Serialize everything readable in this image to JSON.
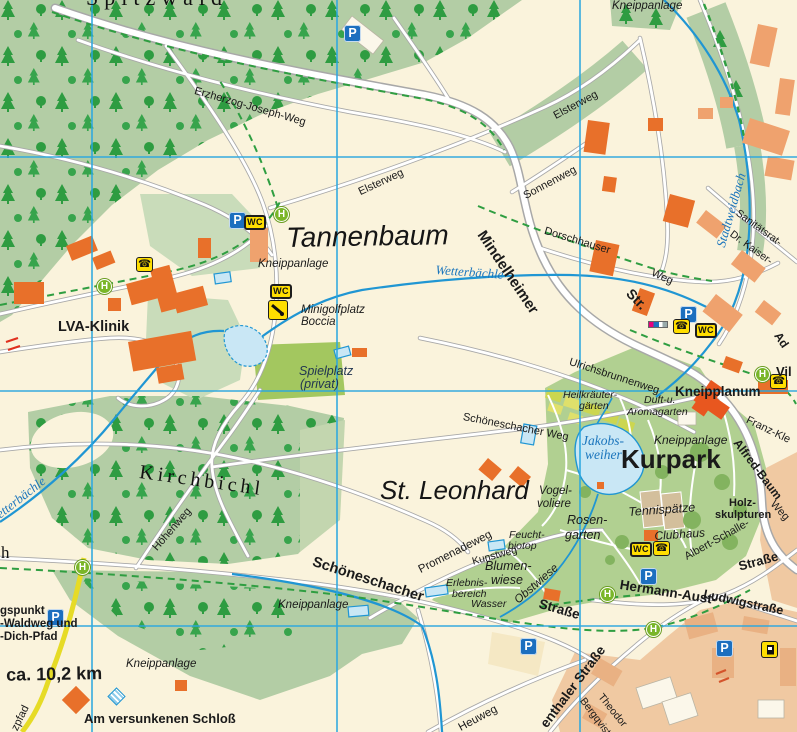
{
  "colors": {
    "background_cream": "#FAF3DC",
    "forest_green": "#B3CDA5",
    "tree_green": "#2E9C41",
    "park_green": "#B1D091",
    "pale_green": "#C9DCBA",
    "playground_lime": "#A3C75F",
    "garden_yellow_green": "#CCD64F",
    "urban_tan": "#F0C9A2",
    "building_orange": "#E8702A",
    "building_salmon": "#EFA26E",
    "road_white": "#FFFFFF",
    "road_casing": "#A8A8A8",
    "grid_blue": "#2AA7E0",
    "stream_blue": "#2096D3",
    "pond_fill": "#C9E7F5",
    "trail_green_dash": "#2F9E41",
    "trail_yellow": "#E6DB26",
    "icon_blue": "#1C6FBF",
    "icon_yellow": "#FFDE00",
    "bus_stop_green": "#7AB629",
    "water_label_blue": "#1B75BC"
  },
  "grid": {
    "vertical_x": [
      92,
      337,
      580
    ],
    "horizontal_y": [
      157,
      391,
      626
    ]
  },
  "icon_glyphs": {
    "parking": "P",
    "wc": "WC",
    "bus_stop": "H",
    "phone": "☎"
  },
  "icons": [
    {
      "type": "parking",
      "x": 344,
      "y": 25
    },
    {
      "type": "parking",
      "x": 229,
      "y": 212
    },
    {
      "type": "parking",
      "x": 680,
      "y": 306
    },
    {
      "type": "parking",
      "x": 640,
      "y": 568
    },
    {
      "type": "parking",
      "x": 520,
      "y": 638
    },
    {
      "type": "parking",
      "x": 47,
      "y": 609
    },
    {
      "type": "parking",
      "x": 716,
      "y": 640
    },
    {
      "type": "wc",
      "x": 244,
      "y": 215
    },
    {
      "type": "wc",
      "x": 270,
      "y": 284
    },
    {
      "type": "wc",
      "x": 695,
      "y": 323
    },
    {
      "type": "wc",
      "x": 630,
      "y": 542
    },
    {
      "type": "bus_stop",
      "x": 274,
      "y": 207
    },
    {
      "type": "bus_stop",
      "x": 97,
      "y": 279
    },
    {
      "type": "bus_stop",
      "x": 75,
      "y": 560
    },
    {
      "type": "bus_stop",
      "x": 755,
      "y": 367
    },
    {
      "type": "bus_stop",
      "x": 600,
      "y": 587
    },
    {
      "type": "bus_stop",
      "x": 646,
      "y": 622
    },
    {
      "type": "phone",
      "x": 136,
      "y": 257
    },
    {
      "type": "phone",
      "x": 673,
      "y": 319
    },
    {
      "type": "phone",
      "x": 653,
      "y": 541
    },
    {
      "type": "phone",
      "x": 770,
      "y": 374
    },
    {
      "type": "fuel",
      "x": 761,
      "y": 641
    },
    {
      "type": "minigolf",
      "x": 268,
      "y": 300
    },
    {
      "type": "kneipp",
      "x": 110,
      "y": 690
    },
    {
      "type": "poi_strip",
      "x": 648,
      "y": 321
    }
  ],
  "labels": [
    {
      "id": "spitzwald",
      "text": "Spitzwald",
      "x": 86,
      "y": -13,
      "r": 0,
      "cls": "serif",
      "fs": 22,
      "ls": 6
    },
    {
      "id": "erzherzog-joseph-weg",
      "text": "Erzherzog-Joseph-Weg",
      "x": 196,
      "y": 86,
      "r": 16,
      "cls": "n",
      "fs": 11
    },
    {
      "id": "kneippanlage-top",
      "text": "Kneippanlage",
      "x": 612,
      "y": 1,
      "r": 0,
      "cls": "it",
      "fs": 11.5
    },
    {
      "id": "elsterweg-east",
      "text": "Elsterweg",
      "x": 552,
      "y": 112,
      "r": -28,
      "cls": "n",
      "fs": 11
    },
    {
      "id": "elsterweg-west",
      "text": "Elsterweg",
      "x": 357,
      "y": 188,
      "r": -25,
      "cls": "n",
      "fs": 11
    },
    {
      "id": "sonnenweg",
      "text": "Sonnenweg",
      "x": 522,
      "y": 192,
      "r": -28,
      "cls": "n",
      "fs": 11
    },
    {
      "id": "mindelheimer",
      "text": "Mindelheimer",
      "x": 487,
      "y": 228,
      "r": 56,
      "cls": "b",
      "fs": 15
    },
    {
      "id": "str",
      "text": "Str.",
      "x": 634,
      "y": 286,
      "r": 46,
      "cls": "b",
      "fs": 14
    },
    {
      "id": "dorschhauser",
      "text": "Dorschhauser",
      "x": 546,
      "y": 226,
      "r": 17,
      "cls": "n",
      "fs": 11
    },
    {
      "id": "dorschhauser-weg",
      "text": "Weg",
      "x": 654,
      "y": 268,
      "r": 24,
      "cls": "n",
      "fs": 11
    },
    {
      "id": "stadtweidbach",
      "text": "Stadtweidbach",
      "x": 714,
      "y": 245,
      "r": -74,
      "cls": "w",
      "fs": 13
    },
    {
      "id": "sanitaetsrat",
      "text": "Sanitätsrat-",
      "x": 740,
      "y": 208,
      "r": 36,
      "cls": "n",
      "fs": 10.5
    },
    {
      "id": "dr-kaiser",
      "text": "Dr. Kaiser-",
      "x": 734,
      "y": 229,
      "r": 36,
      "cls": "n",
      "fs": 10.5
    },
    {
      "id": "tannenbaum",
      "text": "Tannenbaum",
      "x": 286,
      "y": 224,
      "r": -1,
      "cls": "pl",
      "fs": 28
    },
    {
      "id": "kneippanlage-tannenbaum",
      "text": "Kneippanlage",
      "x": 258,
      "y": 259,
      "r": 0,
      "cls": "it",
      "fs": 11.5
    },
    {
      "id": "wetterbaechle-mid",
      "text": "Wetterbächle",
      "x": 436,
      "y": 263,
      "r": 4,
      "cls": "w",
      "fs": 13
    },
    {
      "id": "minigolfplatz",
      "text": "Minigolfplatz",
      "x": 301,
      "y": 305,
      "r": 0,
      "cls": "it",
      "fs": 11.5
    },
    {
      "id": "boccia",
      "text": "Boccia",
      "x": 301,
      "y": 317,
      "r": 0,
      "cls": "it",
      "fs": 11.5
    },
    {
      "id": "lva-klinik",
      "text": "LVA-Klinik",
      "x": 58,
      "y": 320,
      "r": 0,
      "cls": "b",
      "fs": 14.5
    },
    {
      "id": "spielplatz",
      "text": "Spielplatz",
      "x": 299,
      "y": 365,
      "r": 0,
      "cls": "nav",
      "fs": 12.5
    },
    {
      "id": "spielplatz-privat",
      "text": "(privat)",
      "x": 300,
      "y": 378,
      "r": 0,
      "cls": "nav",
      "fs": 12.5
    },
    {
      "id": "ulrichsbrunnenweg",
      "text": "Ulrichsbrunnenweg",
      "x": 571,
      "y": 357,
      "r": 18,
      "cls": "n",
      "fs": 11
    },
    {
      "id": "heilkraeuter-1",
      "text": "Heilkräuter-",
      "x": 563,
      "y": 390,
      "r": 0,
      "cls": "it",
      "fs": 10.5
    },
    {
      "id": "heilkraeuter-2",
      "text": "gärten",
      "x": 579,
      "y": 401,
      "r": 0,
      "cls": "it",
      "fs": 10.5
    },
    {
      "id": "duft-u",
      "text": "Duft-u.",
      "x": 644,
      "y": 395,
      "r": 0,
      "cls": "it",
      "fs": 10.5
    },
    {
      "id": "aromagarten",
      "text": "Aromagarten",
      "x": 627,
      "y": 407,
      "r": 0,
      "cls": "it",
      "fs": 10.5
    },
    {
      "id": "kneipplanum",
      "text": "Kneipplanum",
      "x": 675,
      "y": 385,
      "r": 0,
      "cls": "b",
      "fs": 13.5
    },
    {
      "id": "franz-kle",
      "text": "Franz-Kle",
      "x": 749,
      "y": 415,
      "r": 26,
      "cls": "n",
      "fs": 11
    },
    {
      "id": "jakobsweiher-1",
      "text": "Jakobs-",
      "x": 582,
      "y": 434,
      "r": 0,
      "cls": "w",
      "fs": 13.5
    },
    {
      "id": "jakobsweiher-2",
      "text": "weiher",
      "x": 585,
      "y": 448,
      "r": 0,
      "cls": "w",
      "fs": 13.5
    },
    {
      "id": "kneippanlage-kurpark",
      "text": "Kneippanlage",
      "x": 654,
      "y": 434,
      "r": 0,
      "cls": "it",
      "fs": 12
    },
    {
      "id": "kurpark",
      "text": "Kurpark",
      "x": 621,
      "y": 446,
      "r": 0,
      "cls": "b",
      "fs": 26
    },
    {
      "id": "alfred-baum",
      "text": "Alfred-Baum",
      "x": 741,
      "y": 437,
      "r": 53,
      "cls": "b",
      "fs": 12
    },
    {
      "id": "weg-right",
      "text": "Weg",
      "x": 776,
      "y": 499,
      "r": 48,
      "cls": "n",
      "fs": 11
    },
    {
      "id": "vogelvoliere-1",
      "text": "Vogel-",
      "x": 539,
      "y": 486,
      "r": 0,
      "cls": "it",
      "fs": 11.5
    },
    {
      "id": "vogelvoliere-2",
      "text": "voliere",
      "x": 537,
      "y": 499,
      "r": 0,
      "cls": "it",
      "fs": 11.5
    },
    {
      "id": "rosengarten-1",
      "text": "Rosen-",
      "x": 567,
      "y": 514,
      "r": 0,
      "cls": "it",
      "fs": 12.5
    },
    {
      "id": "rosengarten-2",
      "text": "garten",
      "x": 565,
      "y": 529,
      "r": 0,
      "cls": "it",
      "fs": 12.5
    },
    {
      "id": "st-leonhard",
      "text": "St. Leonhard",
      "x": 380,
      "y": 477,
      "r": 0,
      "cls": "pl",
      "fs": 26
    },
    {
      "id": "promenadeweg",
      "text": "Promenadeweg",
      "x": 417,
      "y": 566,
      "r": -27,
      "cls": "n",
      "fs": 11.5
    },
    {
      "id": "kunstweg",
      "text": "Kunstweg",
      "x": 471,
      "y": 557,
      "r": -15,
      "cls": "n",
      "fs": 10.5
    },
    {
      "id": "feuchtbiotop-1",
      "text": "Feucht-",
      "x": 509,
      "y": 530,
      "r": 0,
      "cls": "it",
      "fs": 10.5
    },
    {
      "id": "feuchtbiotop-2",
      "text": "biotop",
      "x": 508,
      "y": 541,
      "r": 0,
      "cls": "it",
      "fs": 10.5
    },
    {
      "id": "blumenwiese-1",
      "text": "Blumen-",
      "x": 485,
      "y": 560,
      "r": 0,
      "cls": "it",
      "fs": 12.5
    },
    {
      "id": "blumenwiese-2",
      "text": "wiese",
      "x": 491,
      "y": 574,
      "r": 0,
      "cls": "it",
      "fs": 12.5
    },
    {
      "id": "obstwiese",
      "text": "Obstwiese",
      "x": 513,
      "y": 598,
      "r": -41,
      "cls": "it",
      "fs": 11.5
    },
    {
      "id": "erlebnisbereich-1",
      "text": "Erlebnis-",
      "x": 446,
      "y": 578,
      "r": 0,
      "cls": "it",
      "fs": 10.5
    },
    {
      "id": "erlebnisbereich-2",
      "text": "bereich",
      "x": 452,
      "y": 589,
      "r": 0,
      "cls": "it",
      "fs": 10.5
    },
    {
      "id": "erlebnisbereich-3",
      "text": "Wasser",
      "x": 471,
      "y": 599,
      "r": 0,
      "cls": "it",
      "fs": 10.5
    },
    {
      "id": "schoeneschacher",
      "text": "Schöneschacher",
      "x": 315,
      "y": 555,
      "r": 18,
      "cls": "b",
      "fs": 14.5
    },
    {
      "id": "strasse-schoeneschacher",
      "text": "Straße",
      "x": 541,
      "y": 597,
      "r": 16,
      "cls": "b",
      "fs": 13.5
    },
    {
      "id": "schoeneschacher-weg",
      "text": "Schöneschacher Weg",
      "x": 464,
      "y": 412,
      "r": 11,
      "cls": "n",
      "fs": 11
    },
    {
      "id": "hermann-aust",
      "text": "Hermann-Aust-",
      "x": 621,
      "y": 578,
      "r": 9,
      "cls": "b",
      "fs": 13.5
    },
    {
      "id": "strasse-hermann-aust",
      "text": "Straße",
      "x": 737,
      "y": 560,
      "r": -15,
      "cls": "b",
      "fs": 13
    },
    {
      "id": "ludwigstrasse",
      "text": "Ludwigstraße",
      "x": 705,
      "y": 588,
      "r": 12,
      "cls": "b",
      "fs": 12.5
    },
    {
      "id": "kirchbichl",
      "text": "Kirchbichl",
      "x": 141,
      "y": 462,
      "r": 8,
      "cls": "serif",
      "fs": 20,
      "ls": 4
    },
    {
      "id": "hoehenweg",
      "text": "Höhenweg",
      "x": 151,
      "y": 546,
      "r": -49,
      "cls": "n",
      "fs": 11
    },
    {
      "id": "wetterbaechle-west",
      "text": "Wetterbächle",
      "x": -14,
      "y": 516,
      "r": -38,
      "cls": "w",
      "fs": 13
    },
    {
      "id": "cut-h",
      "text": "h",
      "x": 1,
      "y": 544,
      "r": 0,
      "cls": "serif",
      "fs": 17
    },
    {
      "id": "tennisplaetze",
      "text": "Tennispätze",
      "x": 628,
      "y": 506,
      "r": -4,
      "cls": "it",
      "fs": 12.5
    },
    {
      "id": "clubhaus",
      "text": "Clubhaus",
      "x": 654,
      "y": 530,
      "r": -4,
      "cls": "it",
      "fs": 12
    },
    {
      "id": "holzskulpturen-1",
      "text": "Holz-",
      "x": 729,
      "y": 498,
      "r": 0,
      "cls": "b",
      "fs": 11
    },
    {
      "id": "holzskulpturen-2",
      "text": "skulpturen",
      "x": 715,
      "y": 510,
      "r": 0,
      "cls": "b",
      "fs": 11
    },
    {
      "id": "albert-schalle",
      "text": "Albert-Schalle-",
      "x": 683,
      "y": 553,
      "r": -29,
      "cls": "n",
      "fs": 11
    },
    {
      "id": "heuweg",
      "text": "Heuweg",
      "x": 457,
      "y": 724,
      "r": -28,
      "cls": "n",
      "fs": 11.5
    },
    {
      "id": "enthaler-strasse",
      "text": "enthaler Straße",
      "x": 538,
      "y": 722,
      "r": -53,
      "cls": "b",
      "fs": 13.5
    },
    {
      "id": "theodor",
      "text": "Theodor",
      "x": 604,
      "y": 692,
      "r": 51,
      "cls": "n",
      "fs": 10.5
    },
    {
      "id": "bergqvist",
      "text": "Bergqvist",
      "x": 586,
      "y": 696,
      "r": 53,
      "cls": "n",
      "fs": 10.5
    },
    {
      "id": "ausgangspunkt-1",
      "text": "gspunkt",
      "x": 0,
      "y": 606,
      "r": 0,
      "cls": "b",
      "fs": 11.5
    },
    {
      "id": "ausgangspunkt-2",
      "text": "-Waldweg und",
      "x": 0,
      "y": 619,
      "r": 0,
      "cls": "b",
      "fs": 11.5
    },
    {
      "id": "ausgangspunkt-3",
      "text": "-Dich-Pfad",
      "x": 0,
      "y": 632,
      "r": 0,
      "cls": "b",
      "fs": 11.5
    },
    {
      "id": "distance",
      "text": "g ca. 10,2 km",
      "x": -10,
      "y": 666,
      "r": -1,
      "cls": "b",
      "fs": 18
    },
    {
      "id": "kneippanlage-bottom-mid",
      "text": "Kneippanlage",
      "x": 278,
      "y": 600,
      "r": 0,
      "cls": "it",
      "fs": 11.5
    },
    {
      "id": "kneippanlage-bottom-left",
      "text": "Kneippanlage",
      "x": 126,
      "y": 659,
      "r": 0,
      "cls": "it",
      "fs": 11.5
    },
    {
      "id": "am-versunkenen-schloss",
      "text": "Am versunkenen Schloß",
      "x": 84,
      "y": 712,
      "r": 0,
      "cls": "b",
      "fs": 13
    },
    {
      "id": "zpfad",
      "text": "zpfad",
      "x": 10,
      "y": 728,
      "r": -64,
      "cls": "n",
      "fs": 11
    },
    {
      "id": "vil",
      "text": "Vil",
      "x": 776,
      "y": 365,
      "r": 0,
      "cls": "b",
      "fs": 13
    },
    {
      "id": "ad",
      "text": "Ad",
      "x": 782,
      "y": 330,
      "r": 56,
      "cls": "b",
      "fs": 12
    }
  ]
}
